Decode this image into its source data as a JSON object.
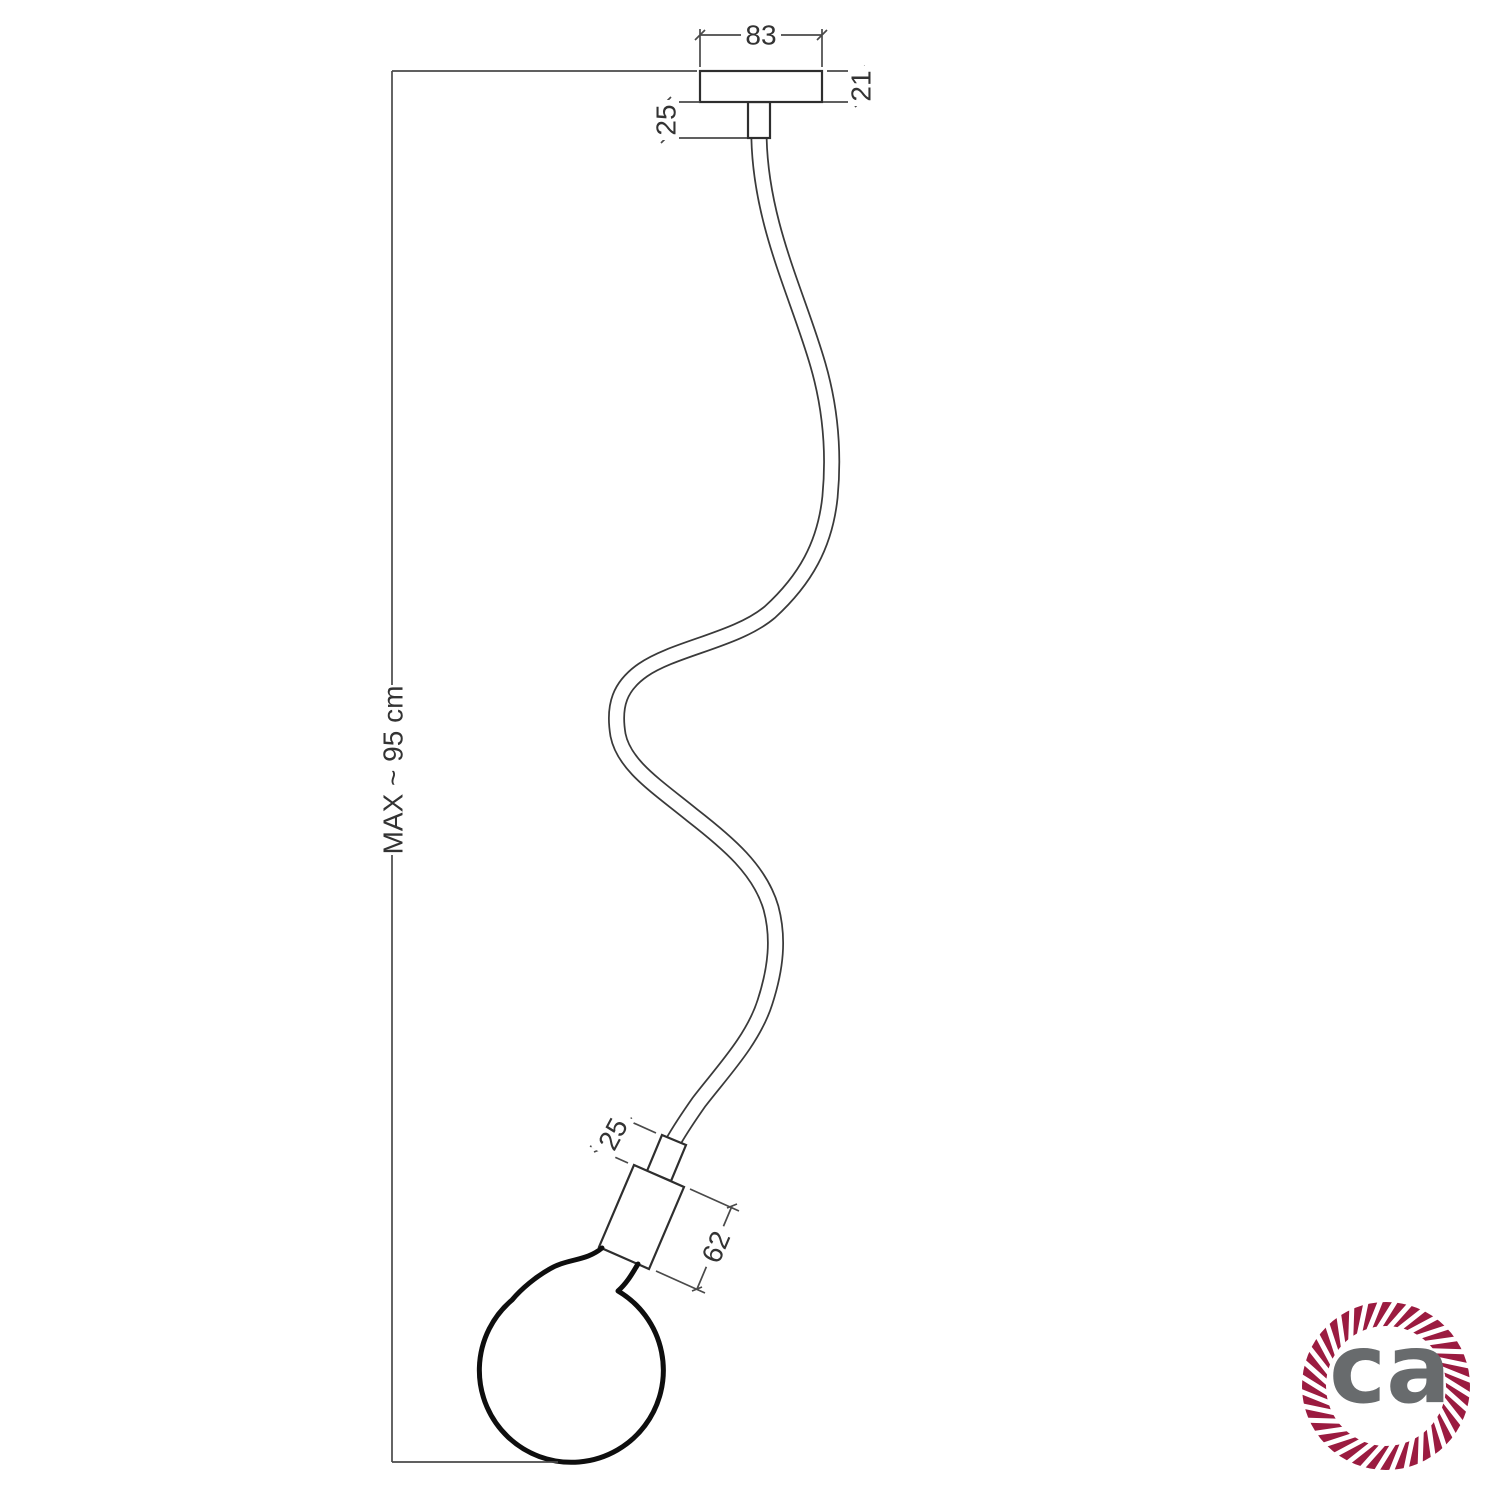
{
  "drawing": {
    "dim_canopy_width": "83",
    "dim_canopy_height": "21",
    "dim_ceiling_nipple": "25",
    "dim_socket_nipple": "25",
    "dim_socket_length": "62",
    "dim_max_drop": "MAX ~ 95 cm"
  },
  "logo": {
    "text": "ca",
    "ring_color": "#9b1b40",
    "text_color": "#686b6d"
  }
}
